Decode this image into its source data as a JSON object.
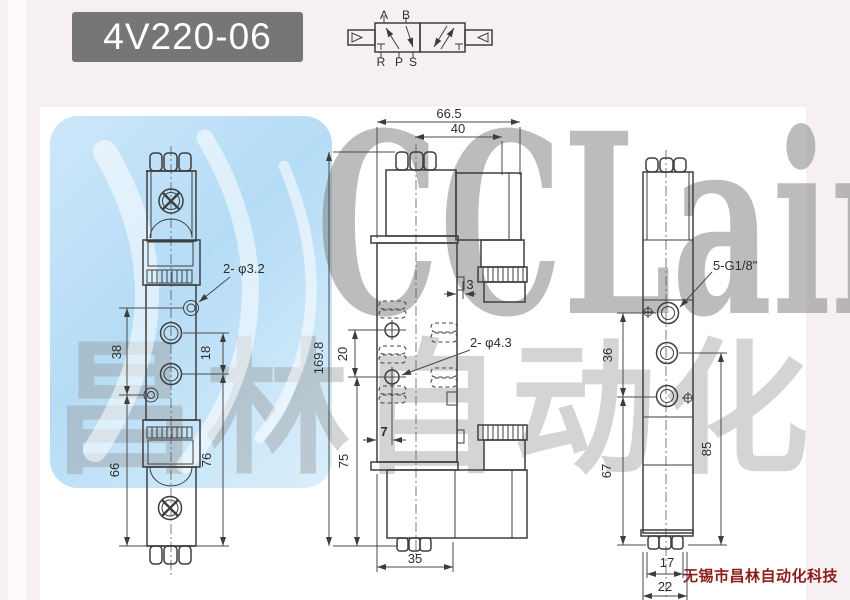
{
  "header": {
    "model": "4V220-06"
  },
  "symbol": {
    "port_a": "A",
    "port_b": "B",
    "port_r": "R",
    "port_p": "P",
    "port_s": "S"
  },
  "views": {
    "side": {
      "holes_label": "2- φ3.2",
      "dim_38": "38",
      "dim_18": "18",
      "dim_66": "66",
      "dim_76": "76"
    },
    "front": {
      "dim_width": "66.5",
      "dim_40": "40",
      "dim_3": "3",
      "dim_height": "169.8",
      "dim_20": "20",
      "holes_label": "2- φ4.3",
      "dim_7": "7",
      "dim_75": "75",
      "dim_35": "35"
    },
    "end": {
      "ports_label": "5-G1/8\"",
      "dim_36": "36",
      "dim_67": "67",
      "dim_85": "85",
      "dim_17": "17",
      "dim_22": "22"
    }
  },
  "watermark": {
    "brand": "CCLair",
    "chinese": "昌林自动化"
  },
  "footer": {
    "company": "无锡市昌林自动化科技"
  }
}
